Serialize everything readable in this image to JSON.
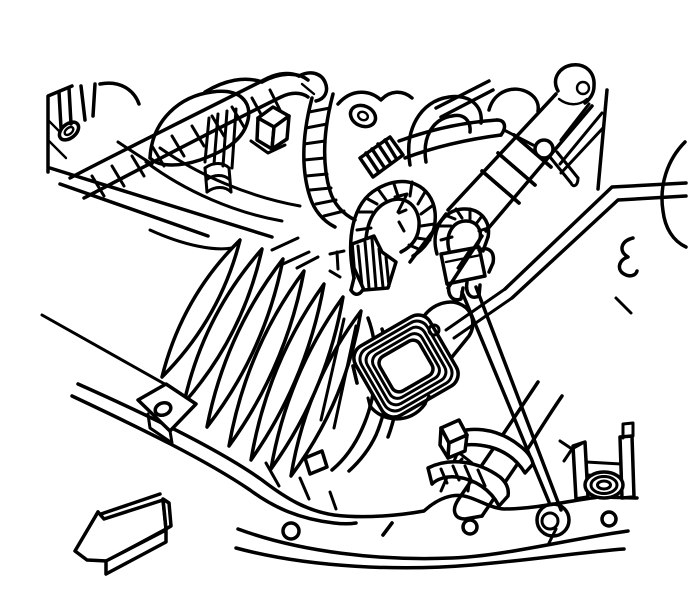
{
  "figure": {
    "type": "technical-line-illustration",
    "description": "Service manual line drawing of an engine compartment viewed from above: a corrugated air intake duct (bellows) runs diagonally down to the front frame rail, with a mass air flow sensor on its outlet. Around it are wiring harness conduits, heater hoses, a hose clamp, mounting brackets with a rubber grommet, and the frame rail with bolt holes. A 3D block arrow at the lower left indicates direction toward the front left of the vehicle.",
    "background_color": "#ffffff",
    "line_color": "#000000",
    "canvas_width": 688,
    "canvas_height": 612,
    "aria_label": "Engine compartment illustration showing intake duct bellows, air flow sensor, wiring harness, hoses, frame rail and a direction arrow pointing to the lower left"
  },
  "components": [
    {
      "name": "engine-assembly",
      "role": "engine block and valve cover outlines, upper left"
    },
    {
      "name": "wiring-harness-conduit",
      "role": "ribbed corrugated conduit band crossing upper left"
    },
    {
      "name": "corrugated-loom-loops",
      "role": "looped corrugated wire looms, center"
    },
    {
      "name": "electrical-connector",
      "role": "hatched connector plug on harness"
    },
    {
      "name": "hanging-connector",
      "role": "unplugged connector with two terminals"
    },
    {
      "name": "intake-duct-upper",
      "role": "smooth duct with clamp rings, upper right"
    },
    {
      "name": "intake-duct-bellows",
      "role": "large corrugated bellows duct, center left"
    },
    {
      "name": "maf-sensor",
      "role": "mass air flow sensor with concentric flange rings"
    },
    {
      "name": "heater-hose",
      "role": "hose with worm clamp near lower right"
    },
    {
      "name": "hose-clamp",
      "role": "clamp saddle with bolt on hose"
    },
    {
      "name": "support-strut",
      "role": "diagonal brace to frame rail"
    },
    {
      "name": "grommet-bracket",
      "role": "bracket with rubber grommet on rail"
    },
    {
      "name": "mount-plate",
      "role": "small mounting tab with hole on rail, left"
    },
    {
      "name": "frame-rail",
      "role": "front frame rail with holes along bottom"
    },
    {
      "name": "direction-arrow",
      "role": "3D block arrow pointing to lower left"
    }
  ],
  "arrow": {
    "direction": "lower-left",
    "style": "3d-block"
  }
}
